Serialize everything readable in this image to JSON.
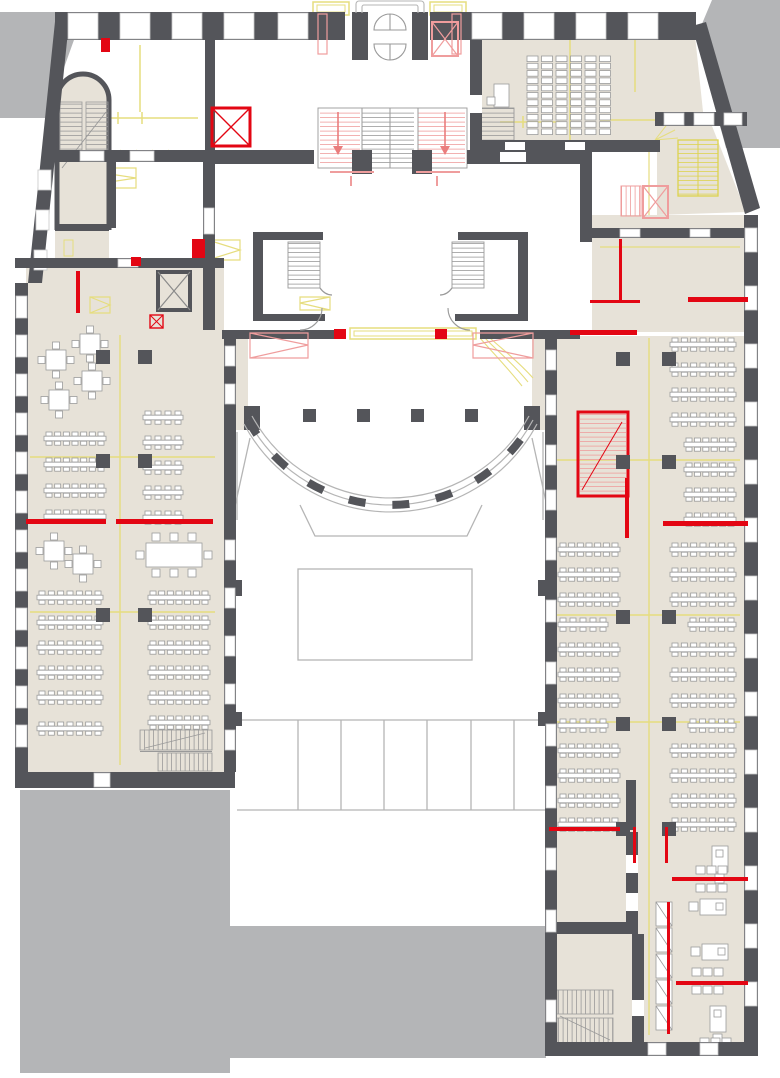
{
  "meta": {
    "type": "floor-plan",
    "visible_text": []
  },
  "colors": {
    "background": "#ffffff",
    "adjacent_buildings": "#b4b5b7",
    "walls": "#54555a",
    "floor": "#e7e2d8",
    "accent_red": "#e30613",
    "accent_pink": "#ef9d9d",
    "annotation_yellow": "#e6dd7e",
    "drawing_lines": "#b5b5b5",
    "furniture_lines": "#9b9b9b"
  },
  "lecture_hall": {
    "seat_cols": 6,
    "seat_rows": 11,
    "x": 527,
    "y": 56,
    "col_pitch": 14.5,
    "row_pitch": 7.3,
    "cell_w": 11,
    "cell_h": 5.6,
    "podium": {
      "x": 494,
      "y": 84,
      "w": 15,
      "h": 23,
      "tray": {
        "x": 487,
        "y": 97,
        "w": 8,
        "h": 8
      }
    }
  },
  "courtyard": {
    "columns": [
      [
        303,
        409
      ],
      [
        357,
        409
      ],
      [
        411,
        409
      ],
      [
        465,
        409
      ]
    ],
    "column_size": 13
  },
  "structure_columns": {
    "size": 14,
    "left_wing": [
      [
        96,
        350
      ],
      [
        138,
        350
      ],
      [
        96,
        454
      ],
      [
        138,
        454
      ],
      [
        96,
        608
      ],
      [
        138,
        608
      ]
    ],
    "right_wing": [
      [
        616,
        352
      ],
      [
        662,
        352
      ],
      [
        616,
        455
      ],
      [
        662,
        455
      ],
      [
        616,
        610
      ],
      [
        662,
        610
      ],
      [
        616,
        717
      ],
      [
        662,
        717
      ],
      [
        616,
        822
      ],
      [
        662,
        822
      ]
    ]
  },
  "square_tables": [
    [
      90,
      344
    ],
    [
      56,
      360
    ],
    [
      92,
      381
    ],
    [
      59,
      400
    ],
    [
      54,
      551
    ],
    [
      83,
      564
    ]
  ],
  "conference_table": {
    "x": 146,
    "y": 543,
    "w": 56,
    "h": 24
  },
  "row_tables": {
    "left_wing_upper_inner": {
      "x": 44,
      "w": 62,
      "ys": [
        432,
        458,
        484,
        510
      ]
    },
    "left_wing_upper_outer": {
      "x": 143,
      "w": 40,
      "ys": [
        411,
        436,
        461,
        486,
        511
      ]
    },
    "left_wing_lower_inner": {
      "x": 37,
      "w": 66,
      "ys": [
        591,
        616,
        641,
        666,
        691,
        722
      ]
    },
    "left_wing_lower_outer": {
      "x": 148,
      "w": 62,
      "ys": [
        591,
        616,
        641,
        666,
        691,
        716
      ]
    },
    "right_wing_upper": {
      "x": 670,
      "w": 66,
      "ys": [
        338,
        363,
        388,
        413
      ]
    },
    "right_wing_upper_short": {
      "x": 684,
      "w": 52,
      "ys": [
        438,
        463,
        488,
        513
      ]
    },
    "right_wing_lower_west": {
      "x": 558,
      "w": 62,
      "ys": [
        543,
        568,
        593,
        643,
        668,
        694,
        744,
        769,
        794,
        818
      ]
    },
    "right_wing_lower_west_short": {
      "x": 558,
      "w": 50,
      "ys": [
        618,
        719
      ]
    },
    "right_wing_lower_east": {
      "x": 670,
      "w": 66,
      "ys": [
        543,
        568,
        593,
        643,
        668,
        694,
        744,
        769,
        794,
        818
      ]
    },
    "right_wing_lower_east_short": {
      "x": 688,
      "w": 48,
      "ys": [
        618,
        719
      ]
    }
  },
  "offices": {
    "desks": [
      {
        "x": 712,
        "y": 846,
        "vert": true
      },
      {
        "x": 700,
        "y": 899,
        "vert": false
      },
      {
        "x": 702,
        "y": 944,
        "vert": false
      },
      {
        "x": 710,
        "y": 1006,
        "vert": true
      }
    ],
    "shelves": {
      "x": 656,
      "y0": 902,
      "step": 26,
      "count": 5
    },
    "chair_groups": [
      [
        696,
        866
      ],
      [
        696,
        884
      ],
      [
        692,
        968
      ],
      [
        692,
        986
      ],
      [
        700,
        1038
      ]
    ]
  },
  "windows_walls": [
    {
      "name": "left-wing-west-wall",
      "x": 15,
      "y": 283,
      "len": 492,
      "th": 13,
      "dir": "v",
      "wins": [
        [
          296,
          22
        ],
        [
          335,
          22
        ],
        [
          374,
          22
        ],
        [
          413,
          22
        ],
        [
          452,
          22
        ],
        [
          491,
          22
        ],
        [
          530,
          22
        ],
        [
          569,
          22
        ],
        [
          608,
          22
        ],
        [
          647,
          22
        ],
        [
          686,
          22
        ],
        [
          725,
          22
        ]
      ]
    },
    {
      "name": "left-wing-east-wall",
      "x": 224,
      "y": 330,
      "len": 442,
      "th": 12,
      "dir": "v",
      "wins": [
        [
          346,
          20
        ],
        [
          384,
          20
        ],
        [
          540,
          20
        ],
        [
          588,
          20
        ],
        [
          636,
          20
        ],
        [
          684,
          20
        ],
        [
          730,
          20
        ]
      ]
    },
    {
      "name": "left-wing-north-wall",
      "x": 15,
      "y": 258,
      "len": 209,
      "th": 10,
      "dir": "h",
      "wins": [
        [
          118,
          20
        ]
      ]
    },
    {
      "name": "left-wing-south-wall",
      "x": 15,
      "y": 772,
      "len": 220,
      "th": 16,
      "dir": "h",
      "wins": [
        [
          94,
          16
        ]
      ]
    },
    {
      "name": "right-wing-east-wall",
      "x": 744,
      "y": 215,
      "len": 841,
      "th": 14,
      "dir": "v",
      "wins": [
        [
          228,
          24
        ],
        [
          286,
          24
        ],
        [
          344,
          24
        ],
        [
          402,
          24
        ],
        [
          460,
          24
        ],
        [
          518,
          24
        ],
        [
          576,
          24
        ],
        [
          634,
          24
        ],
        [
          692,
          24
        ],
        [
          750,
          24
        ],
        [
          808,
          24
        ],
        [
          866,
          24
        ],
        [
          924,
          24
        ],
        [
          982,
          24
        ]
      ]
    },
    {
      "name": "right-wing-west-wall-upper",
      "x": 545,
      "y": 330,
      "len": 190,
      "th": 12,
      "dir": "v",
      "wins": [
        [
          350,
          20
        ],
        [
          395,
          20
        ],
        [
          445,
          20
        ],
        [
          490,
          20
        ]
      ]
    },
    {
      "name": "right-wing-west-wall-lower",
      "x": 545,
      "y": 520,
      "len": 522,
      "th": 12,
      "dir": "v",
      "wins": [
        [
          538,
          22
        ],
        [
          600,
          22
        ],
        [
          662,
          22
        ],
        [
          724,
          22
        ],
        [
          786,
          22
        ],
        [
          848,
          22
        ],
        [
          910,
          22
        ],
        [
          1000,
          22
        ]
      ]
    },
    {
      "name": "right-wing-south-wall",
      "x": 545,
      "y": 1042,
      "len": 213,
      "th": 14,
      "dir": "h",
      "wins": [
        [
          648,
          18
        ],
        [
          700,
          18
        ]
      ]
    },
    {
      "name": "north-wall-west",
      "x": 55,
      "y": 12,
      "len": 290,
      "th": 28,
      "dir": "h",
      "wins": [
        [
          68,
          30
        ],
        [
          120,
          30
        ],
        [
          172,
          30
        ],
        [
          224,
          30
        ],
        [
          278,
          30
        ]
      ]
    },
    {
      "name": "north-wall-east",
      "x": 430,
      "y": 12,
      "len": 266,
      "th": 28,
      "dir": "h",
      "wins": [
        [
          472,
          30
        ],
        [
          524,
          30
        ],
        [
          576,
          30
        ],
        [
          628,
          30
        ]
      ]
    },
    {
      "name": "ne-block-top-wall",
      "x": 655,
      "y": 112,
      "len": 92,
      "th": 14,
      "dir": "h",
      "wins": [
        [
          664,
          20
        ],
        [
          694,
          20
        ],
        [
          724,
          18
        ]
      ]
    },
    {
      "name": "nw-rooms-top-wall",
      "x": 44,
      "y": 150,
      "len": 161,
      "th": 12,
      "dir": "h",
      "wins": [
        [
          80,
          24
        ],
        [
          130,
          24
        ]
      ]
    },
    {
      "name": "lobby-west-wall",
      "x": 203,
      "y": 150,
      "len": 180,
      "th": 12,
      "dir": "v",
      "wins": [
        [
          208,
          26
        ]
      ]
    },
    {
      "name": "corridor-north-wall",
      "x": 580,
      "y": 228,
      "len": 164,
      "th": 10,
      "dir": "h",
      "wins": [
        [
          620,
          20
        ],
        [
          690,
          20
        ]
      ]
    }
  ]
}
